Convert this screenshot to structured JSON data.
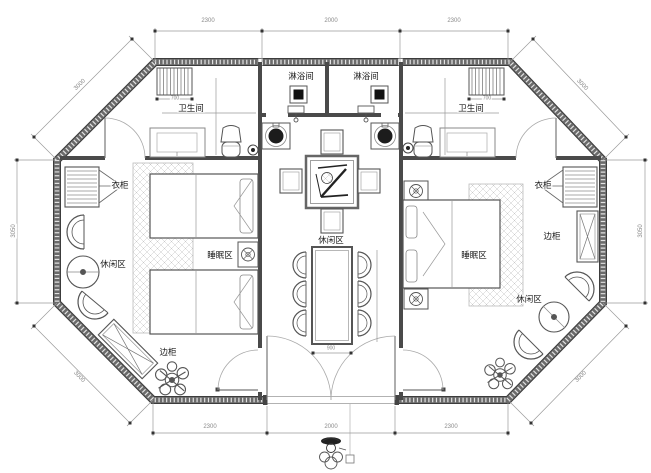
{
  "rooms": {
    "bathroom_left": "卫生间",
    "bathroom_right": "卫生间",
    "shower_left": "淋浴间",
    "shower_right": "淋浴间",
    "wardrobe_left": "衣柜",
    "wardrobe_right": "衣柜",
    "side_cabinet_left": "边柜",
    "side_cabinet_right": "边柜",
    "sleep_left": "睡眠区",
    "sleep_right": "睡眠区",
    "lounge_left": "休闲区",
    "lounge_center": "休闲区",
    "lounge_right": "休闲区"
  },
  "dimensions": {
    "top_left": "2300",
    "top_center": "2000",
    "top_right": "2300",
    "bottom_left": "2300",
    "bottom_center": "2000",
    "bottom_right": "2300",
    "side_left": "3050",
    "side_right": "3050",
    "diag_top_left": "3000",
    "diag_top_right": "3000",
    "diag_bottom_left": "3000",
    "diag_bottom_right": "3000",
    "dining_table_width": "900",
    "rack_left": "700",
    "rack_right": "700"
  },
  "colors": {
    "wall": "#5f5f5f",
    "wall_edge": "#3c3c3c",
    "furniture_line": "#555555",
    "dim_line": "#999999",
    "dim_text": "#8a8a8a",
    "hatch": "#c8c8c8"
  }
}
